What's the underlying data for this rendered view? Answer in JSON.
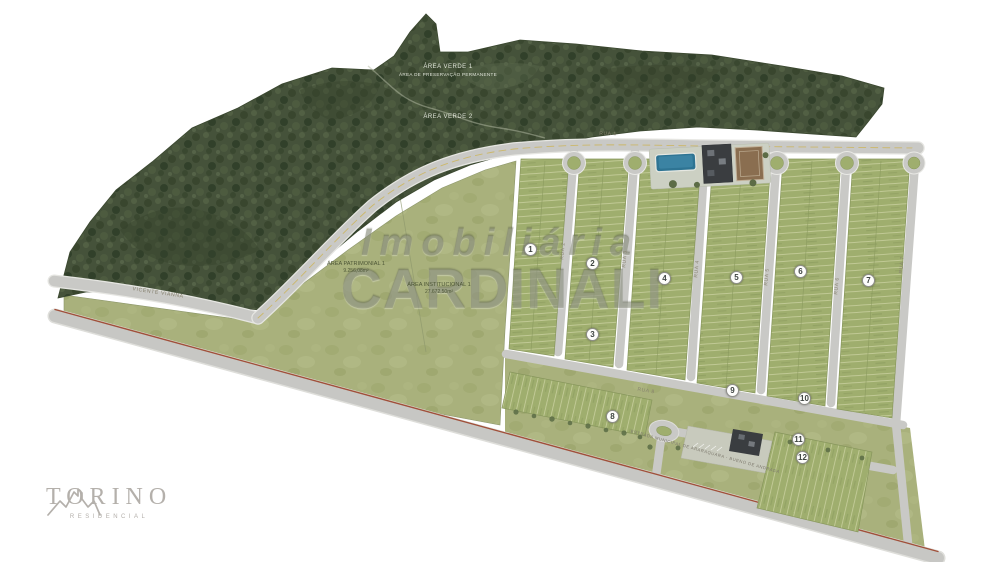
{
  "watermark": {
    "line1": "Imobiliária",
    "line2": "CARDINALI"
  },
  "logo": {
    "title": "TORINO",
    "subtitle": "RESIDENCIAL"
  },
  "areas": {
    "verde1": {
      "title": "ÁREA VERDE 1",
      "subtitle": "ÁREA DE PRESERVAÇÃO PERMANENTE"
    },
    "verde2": {
      "title": "ÁREA VERDE 2"
    },
    "patrimonial": {
      "title": "ÁREA PATRIMONIAL 1",
      "size": "9.256,08m²"
    },
    "institucional": {
      "title": "ÁREA INSTITUCIONAL 1",
      "size": "27.672,50m²"
    }
  },
  "roads": {
    "access": "VICENTE VIANNA",
    "estrada": "ESTRADA MUNICIPAL DE ARARAQUARA - BUENO DE ANDRADA",
    "rua1": "RUA 1",
    "rua2": "RUA 2",
    "rua3": "RUA 3",
    "rua4": "RUA 4",
    "rua5": "RUA 5",
    "rua6": "RUA 6",
    "rua7": "RUA 7",
    "rua8": "RUA 8"
  },
  "quadras": [
    "1",
    "2",
    "3",
    "4",
    "5",
    "6",
    "7",
    "8",
    "9",
    "10",
    "11",
    "12"
  ],
  "colors": {
    "background": "#ffffff",
    "field": "#a9b17c",
    "forest": "#45523a",
    "road": "#c9c9c6",
    "boundary_line": "#a0503a",
    "pool": "#2f7594",
    "watermark_gray": "#6a705a",
    "logo_gray": "#b4b0ab"
  }
}
